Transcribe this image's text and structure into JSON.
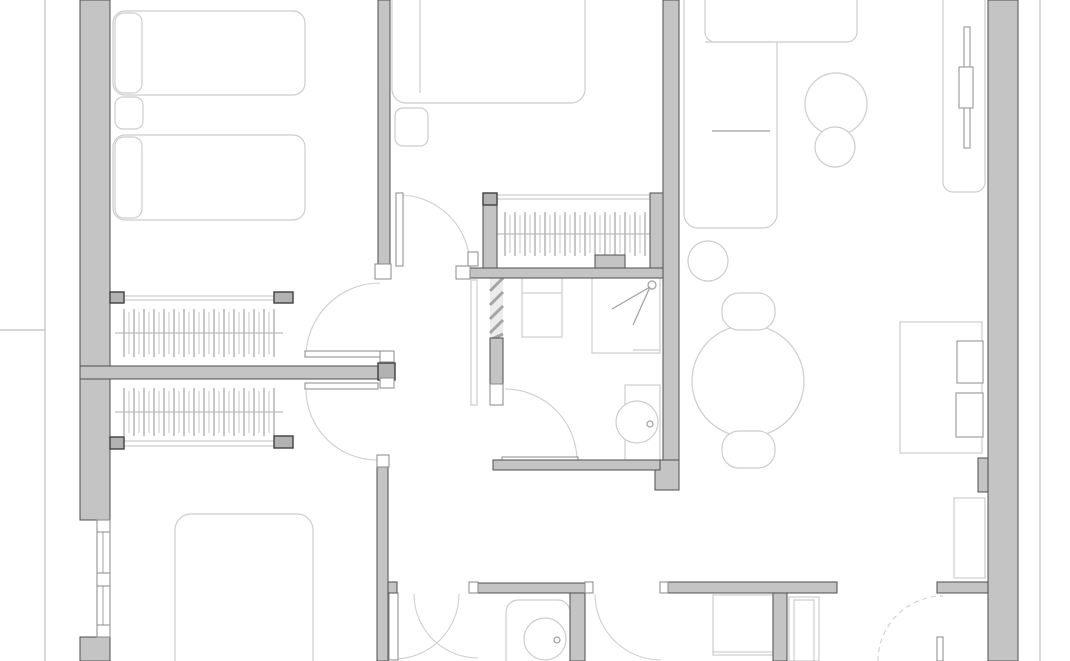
{
  "app": {
    "type": "architectural-floor-plan",
    "view": "2d-top-down-plan"
  },
  "canvas": {
    "width": 1070,
    "height": 661
  },
  "colors": {
    "background": "#ffffff",
    "wall_fill": "#c4c4c4",
    "wall_stroke": "#4e4e4e",
    "cap_fill": "#b2b2b2",
    "cap_stroke": "#3f3f3f",
    "jamb_fill": "#ffffff",
    "jamb_stroke": "#8a8a8a",
    "furniture_light": "#cdcdcd",
    "furniture_mid": "#9f9f9f",
    "arc_stroke": "#cfcfcf",
    "tick_dark": "#8f8f8f",
    "tick_light": "#c6c6c6",
    "rail": "#bdbdbd",
    "hatch_bg": "#ececec",
    "hatch_line": "#a5a5a5",
    "boundary": "#c9c9c9"
  },
  "plan": {
    "boundary_lines": [
      {
        "name": "terrace-edge-left",
        "line": [
          45,
          0,
          45,
          661
        ]
      },
      {
        "name": "terrace-tick-left",
        "line": [
          0,
          330,
          45,
          330
        ]
      },
      {
        "name": "balcony-edge-right",
        "line": [
          1040,
          0,
          1040,
          661
        ]
      }
    ],
    "walls": [
      {
        "name": "wall-exterior-left-upper",
        "rect": [
          80,
          0,
          30,
          520
        ]
      },
      {
        "name": "wall-exterior-left-lower",
        "rect": [
          80,
          637,
          30,
          24
        ]
      },
      {
        "name": "wall-interior-a",
        "rect": [
          378,
          0,
          12,
          265
        ]
      },
      {
        "name": "wall-closet-divider",
        "rect": [
          80,
          366,
          310,
          13
        ]
      },
      {
        "name": "wall-interior-a-lower",
        "rect": [
          377,
          458,
          11,
          203
        ]
      },
      {
        "name": "wall-stub-hall-bottom",
        "rect": [
          388,
          582,
          9,
          11
        ]
      },
      {
        "name": "wall-bathroom1-north",
        "rect": [
          470,
          268,
          202,
          10
        ]
      },
      {
        "name": "wall-closet3-west",
        "rect": [
          483,
          195,
          14,
          73
        ]
      },
      {
        "name": "wall-closet3-east",
        "rect": [
          650,
          193,
          29,
          75
        ]
      },
      {
        "name": "wall-spine-east",
        "rect": [
          663,
          0,
          16,
          463
        ]
      },
      {
        "name": "wall-column-center",
        "rect": [
          655,
          460,
          24,
          30
        ]
      },
      {
        "name": "wall-bathroom1-south",
        "rect": [
          493,
          460,
          167,
          10
        ]
      },
      {
        "name": "wall-bathroom1-west-solid",
        "rect": [
          490,
          338,
          13,
          47
        ]
      },
      {
        "name": "wall-pier-closet3",
        "rect": [
          595,
          255,
          30,
          13
        ]
      },
      {
        "name": "wall-exterior-right",
        "rect": [
          988,
          0,
          30,
          661
        ]
      },
      {
        "name": "wall-pilaster-right",
        "rect": [
          978,
          458,
          10,
          34
        ]
      },
      {
        "name": "wall-bathroom2-north",
        "rect": [
          478,
          583,
          107,
          10
        ]
      },
      {
        "name": "wall-bathroom2-east",
        "rect": [
          570,
          593,
          15,
          68
        ]
      },
      {
        "name": "wall-bottom-east-wing",
        "rect": [
          668,
          582,
          169,
          11
        ]
      },
      {
        "name": "wall-bottom-vertical",
        "rect": [
          773,
          593,
          14,
          68
        ]
      },
      {
        "name": "wall-bottom-right-stub",
        "rect": [
          937,
          582,
          51,
          11
        ]
      }
    ],
    "caps": [
      {
        "name": "cap-closet1-left",
        "rect": [
          110,
          292,
          14,
          11
        ]
      },
      {
        "name": "cap-closet1-right",
        "rect": [
          274,
          292,
          19,
          11
        ]
      },
      {
        "name": "cap-closet2-left",
        "rect": [
          110,
          437,
          14,
          12
        ]
      },
      {
        "name": "cap-closet2-right",
        "rect": [
          274,
          436,
          19,
          12
        ]
      },
      {
        "name": "cap-wall-b-end",
        "rect": [
          378,
          363,
          17,
          17
        ]
      },
      {
        "name": "cap-closet3-corner",
        "rect": [
          483,
          193,
          14,
          12
        ]
      }
    ],
    "jambs": [
      {
        "name": "jamb-wall-a-bottom",
        "rect": [
          375,
          264,
          16,
          15
        ]
      },
      {
        "name": "jamb-wall-b-upper",
        "rect": [
          380,
          351,
          14,
          11
        ]
      },
      {
        "name": "jamb-wall-b-lower",
        "rect": [
          380,
          378,
          14,
          10
        ]
      },
      {
        "name": "jamb-hall-door",
        "rect": [
          468,
          252,
          10,
          14
        ]
      },
      {
        "name": "jamb-bathroom1-north-end",
        "rect": [
          456,
          266,
          14,
          13
        ]
      },
      {
        "name": "jamb-bathroom1-west",
        "rect": [
          490,
          384,
          13,
          21
        ]
      },
      {
        "name": "jamb-wall-a-lower-top",
        "rect": [
          377,
          455,
          12,
          12
        ]
      },
      {
        "name": "jamb-bathroom2-west",
        "rect": [
          469,
          582,
          9,
          11
        ]
      },
      {
        "name": "jamb-bathroom2-east",
        "rect": [
          585,
          582,
          8,
          11
        ]
      },
      {
        "name": "jamb-bottom-east-wing",
        "rect": [
          660,
          582,
          8,
          11
        ]
      }
    ],
    "windows": [
      {
        "name": "window-left-bedroom3",
        "outer": [
          97,
          520,
          13,
          117
        ],
        "centerline": [
          103,
          520,
          103,
          637
        ],
        "mullions": [
          [
            97,
            520,
            13,
            12
          ],
          [
            97,
            573,
            13,
            13
          ],
          [
            97,
            625,
            13,
            12
          ]
        ]
      }
    ],
    "closets": [
      {
        "name": "closet-bedroom1",
        "ticks": {
          "x1": 124,
          "x2": 274,
          "y1": 309,
          "y2": 357,
          "step": 5
        },
        "rail": [
          115,
          333,
          283,
          333
        ],
        "front_lines": [
          [
            122,
            296,
            277,
            296
          ],
          [
            122,
            300,
            277,
            300
          ]
        ]
      },
      {
        "name": "closet-bedroom3",
        "ticks": {
          "x1": 124,
          "x2": 274,
          "y1": 388,
          "y2": 436,
          "step": 5
        },
        "rail": [
          115,
          412,
          283,
          412
        ],
        "front_lines": [
          [
            122,
            441,
            277,
            441
          ],
          [
            122,
            446,
            277,
            446
          ]
        ]
      },
      {
        "name": "closet-hall",
        "ticks": {
          "x1": 505,
          "x2": 647,
          "y1": 212,
          "y2": 256,
          "step": 5
        },
        "rail": [
          497,
          234,
          655,
          234
        ],
        "front_lines": [
          [
            497,
            195,
            650,
            195
          ],
          [
            497,
            199,
            650,
            199
          ]
        ]
      }
    ],
    "diag_hatch": {
      "name": "shaft-hatch-bathroom1-west",
      "rect": [
        490,
        278,
        13,
        62
      ],
      "lines": [
        [
          490,
          291,
          503,
          278
        ],
        [
          490,
          305,
          503,
          292
        ],
        [
          490,
          319,
          503,
          306
        ],
        [
          490,
          333,
          503,
          320
        ],
        [
          490,
          340,
          503,
          334
        ]
      ]
    },
    "doors": [
      {
        "name": "door-hall-top",
        "leaf": [
          396,
          193,
          7,
          73
        ],
        "arc": {
          "cx": 399,
          "cy": 266,
          "r": 71,
          "a1": -90,
          "a2": 0
        }
      },
      {
        "name": "door-bedroom1",
        "leaf": [
          305,
          351,
          75,
          6
        ],
        "arc": {
          "cx": 380,
          "cy": 357,
          "r": 74,
          "a1": 180,
          "a2": 270
        }
      },
      {
        "name": "door-bedroom3",
        "leaf": [
          305,
          383,
          73,
          6
        ],
        "arc": {
          "cx": 377,
          "cy": 389,
          "r": 71,
          "a1": 180,
          "a2": 90
        }
      },
      {
        "name": "door-bathroom1",
        "leaf": [
          502,
          457,
          76,
          6
        ],
        "arc": {
          "cx": 505,
          "cy": 461,
          "r": 72,
          "a1": 270,
          "a2": 360
        }
      },
      {
        "name": "door-hall-bottom",
        "leaf": [
          389,
          593,
          9,
          67
        ],
        "arc": {
          "cx": 394,
          "cy": 594,
          "r": 65,
          "a1": 0,
          "a2": 90
        }
      },
      {
        "name": "door-bathroom2",
        "arc": {
          "cx": 478,
          "cy": 594,
          "r": 64,
          "a1": 180,
          "a2": 90
        }
      },
      {
        "name": "door-room-bottom-mid",
        "arc": {
          "cx": 661,
          "cy": 594,
          "r": 66,
          "a1": 180,
          "a2": 90
        }
      },
      {
        "name": "door-bottom-right",
        "leaf": [
          937,
          637,
          6,
          24
        ],
        "arc": {
          "cx": 943,
          "cy": 661,
          "r": 65,
          "a1": 180,
          "a2": 270,
          "dashed": true
        }
      }
    ],
    "furniture": [
      {
        "name": "bed-single-top",
        "rrect": [
          113,
          11,
          192,
          84,
          12
        ]
      },
      {
        "name": "pillow-bed-single-top",
        "rrect": [
          115,
          13,
          27,
          80,
          9
        ]
      },
      {
        "name": "nightstand-bedroom1",
        "rrect": [
          115,
          97,
          28,
          32,
          8
        ]
      },
      {
        "name": "bed-single-bottom",
        "rrect": [
          113,
          135,
          192,
          85,
          12
        ]
      },
      {
        "name": "pillow-bed-single-bottom",
        "rrect": [
          115,
          137,
          27,
          81,
          9
        ]
      },
      {
        "name": "bed-double-bedroom2",
        "rrect": [
          392,
          -14,
          193,
          117,
          14
        ]
      },
      {
        "name": "pillow-divider-bedroom2",
        "line": [
          420,
          0,
          420,
          93
        ]
      },
      {
        "name": "nightstand-bedroom2",
        "rrect": [
          395,
          108,
          33,
          38,
          8
        ]
      },
      {
        "name": "sofa-body",
        "rrect": [
          684,
          -14,
          93,
          242,
          14
        ]
      },
      {
        "name": "sofa-chaise",
        "rrect": [
          705,
          -12,
          152,
          54,
          10
        ]
      },
      {
        "name": "sofa-seat-line",
        "line": [
          705,
          42,
          772,
          42
        ]
      },
      {
        "name": "sofa-arm-line",
        "line": [
          712,
          131,
          770,
          131
        ],
        "stroke": "mid"
      },
      {
        "name": "coffee-table-large",
        "circle": [
          836,
          104,
          31
        ]
      },
      {
        "name": "coffee-table-small",
        "circle": [
          835,
          147,
          20
        ]
      },
      {
        "name": "side-table",
        "circle": [
          708,
          261,
          20
        ]
      },
      {
        "name": "tv-sideboard",
        "rrect": [
          943,
          -10,
          42,
          202,
          10
        ]
      },
      {
        "name": "tv-screen",
        "rect": [
          964,
          27,
          6,
          121
        ],
        "stroke": "mid"
      },
      {
        "name": "tv-mount",
        "rect": [
          959,
          67,
          14,
          41
        ],
        "stroke": "mid"
      },
      {
        "name": "dining-table",
        "circle": [
          748,
          381,
          56
        ]
      },
      {
        "name": "dining-chair-north",
        "rrect": [
          722,
          293,
          53,
          37,
          17
        ]
      },
      {
        "name": "dining-chair-south",
        "rrect": [
          722,
          431,
          53,
          37,
          17
        ]
      },
      {
        "name": "desk",
        "rect": [
          900,
          322,
          82,
          131
        ]
      },
      {
        "name": "desk-monitor",
        "rect": [
          957,
          341,
          26,
          42
        ],
        "stroke": "mid"
      },
      {
        "name": "desk-chair",
        "rect": [
          956,
          393,
          27,
          44
        ],
        "stroke": "mid"
      },
      {
        "name": "vanity-bathroom1",
        "rect": [
          522,
          278,
          40,
          59
        ]
      },
      {
        "name": "vanity-line",
        "line": [
          522,
          293,
          562,
          293
        ]
      },
      {
        "name": "shower-bathroom1",
        "rect": [
          592,
          278,
          68,
          75
        ]
      },
      {
        "name": "shower-base-line",
        "line": [
          633,
          350,
          660,
          350
        ]
      },
      {
        "name": "shower-head",
        "circle": [
          652,
          285,
          4
        ],
        "stroke": "mid"
      },
      {
        "name": "shower-diag-1",
        "line": [
          650,
          287,
          612,
          309
        ],
        "stroke": "mid"
      },
      {
        "name": "shower-diag-2",
        "line": [
          650,
          287,
          633,
          325
        ],
        "stroke": "mid"
      },
      {
        "name": "toilet-cistern-bathroom1",
        "rect": [
          625,
          385,
          35,
          75
        ]
      },
      {
        "name": "toilet-bowl-bathroom1",
        "circle": [
          637,
          422,
          21
        ]
      },
      {
        "name": "toilet-flush-bathroom1",
        "circle": [
          650,
          424,
          3
        ],
        "stroke": "mid"
      },
      {
        "name": "toilet-enclosure-bathroom2",
        "rrect": [
          506,
          600,
          64,
          75,
          12
        ]
      },
      {
        "name": "toilet-bowl-bathroom2",
        "circle": [
          545,
          639,
          21
        ]
      },
      {
        "name": "toilet-flush-bathroom2",
        "circle": [
          557,
          640,
          3
        ],
        "stroke": "mid"
      },
      {
        "name": "bed-bedroom3",
        "rrect": [
          175,
          514,
          138,
          170,
          16
        ]
      },
      {
        "name": "cabinet-bottom-mid",
        "rect": [
          713,
          595,
          60,
          60
        ]
      },
      {
        "name": "cabinet-bottom-mid-line",
        "line": [
          713,
          652,
          773,
          652
        ]
      },
      {
        "name": "doorframe-bottom-mid",
        "rect": [
          789,
          597,
          30,
          64
        ]
      },
      {
        "name": "doorframe-bottom-mid-inner",
        "rect": [
          794,
          600,
          20,
          61
        ]
      },
      {
        "name": "cabinet-bottom-right",
        "rect": [
          954,
          498,
          31,
          80
        ]
      },
      {
        "name": "pocket-leaf-bathroom1",
        "rect": [
          471,
          280,
          6,
          125
        ]
      }
    ]
  }
}
